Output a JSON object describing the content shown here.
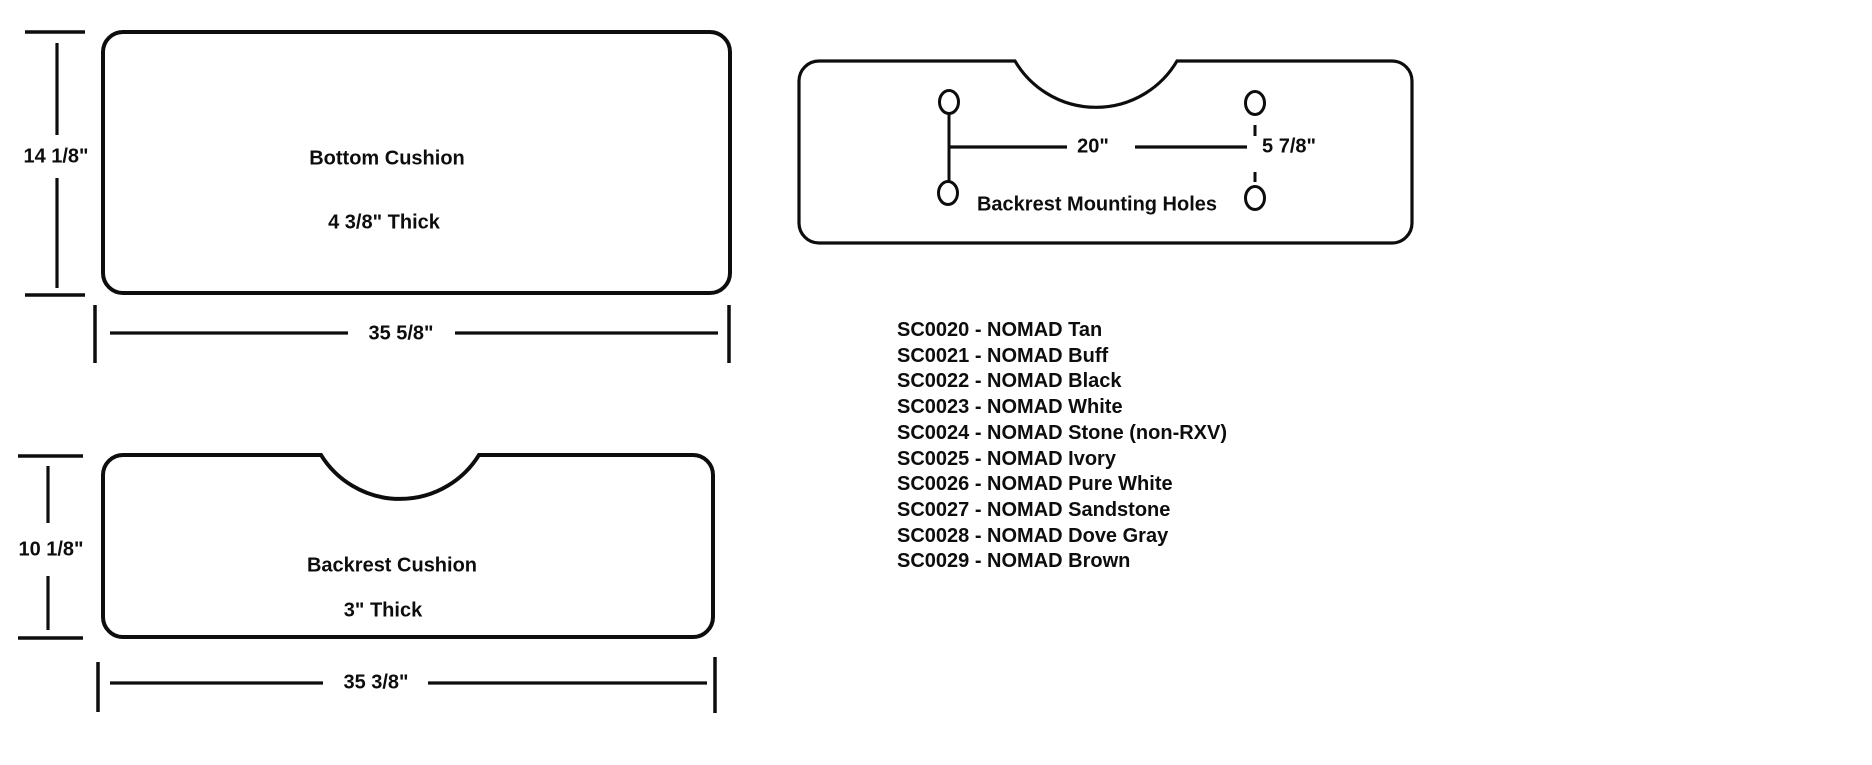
{
  "page": {
    "background_color": "#ffffff",
    "line_color": "#0d0d0d"
  },
  "diagrams": {
    "bottom_cushion": {
      "name_label": "Bottom Cushion",
      "thickness_label": "4 3/8\" Thick",
      "height_dim": "14 1/8\"",
      "width_dim": "35 5/8\""
    },
    "backrest_cushion": {
      "name_label": "Backrest Cushion",
      "thickness_label": "3\" Thick",
      "height_dim": "10 1/8\"",
      "width_dim": "35 3/8\""
    },
    "mounting_holes": {
      "caption": "Backrest Mounting Holes",
      "hole_spacing_dim": "20\"",
      "hole_offset_dim": "5 7/8\""
    }
  },
  "parts_list": {
    "items": [
      "SC0020 - NOMAD Tan",
      "SC0021 - NOMAD Buff",
      "SC0022 - NOMAD Black",
      "SC0023 - NOMAD White",
      "SC0024 - NOMAD Stone (non-RXV)",
      "SC0025 - NOMAD Ivory",
      "SC0026 - NOMAD Pure White",
      "SC0027 - NOMAD Sandstone",
      "SC0028 - NOMAD Dove Gray",
      "SC0029 - NOMAD Brown"
    ]
  }
}
